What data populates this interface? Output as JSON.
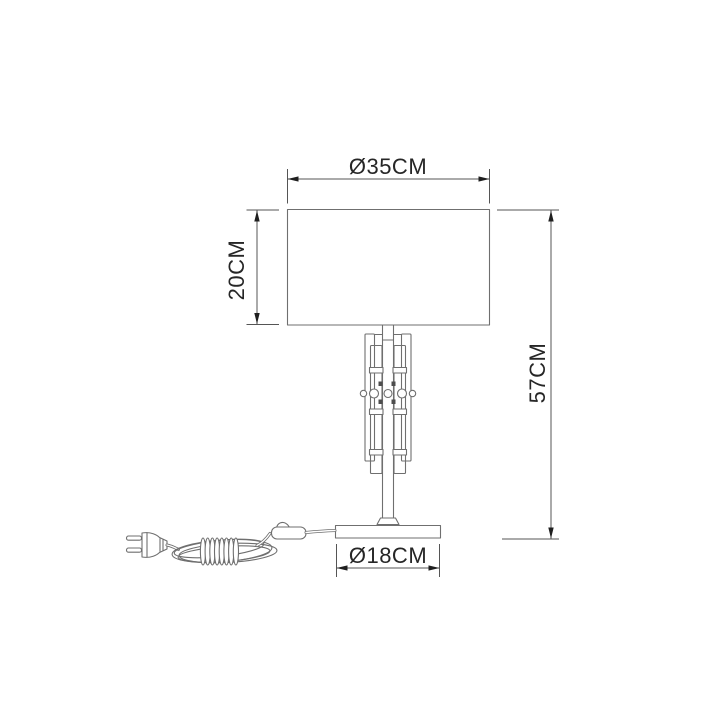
{
  "diagram": {
    "dimension_labels": {
      "shade_diameter": "Ø35CM",
      "shade_height": "20CM",
      "total_height": "57CM",
      "base_diameter": "Ø18CM"
    },
    "colors": {
      "background": "#ffffff",
      "lamp_outline": "#6f6f6f",
      "dimension_line": "#555555",
      "label_text": "#262626"
    }
  }
}
